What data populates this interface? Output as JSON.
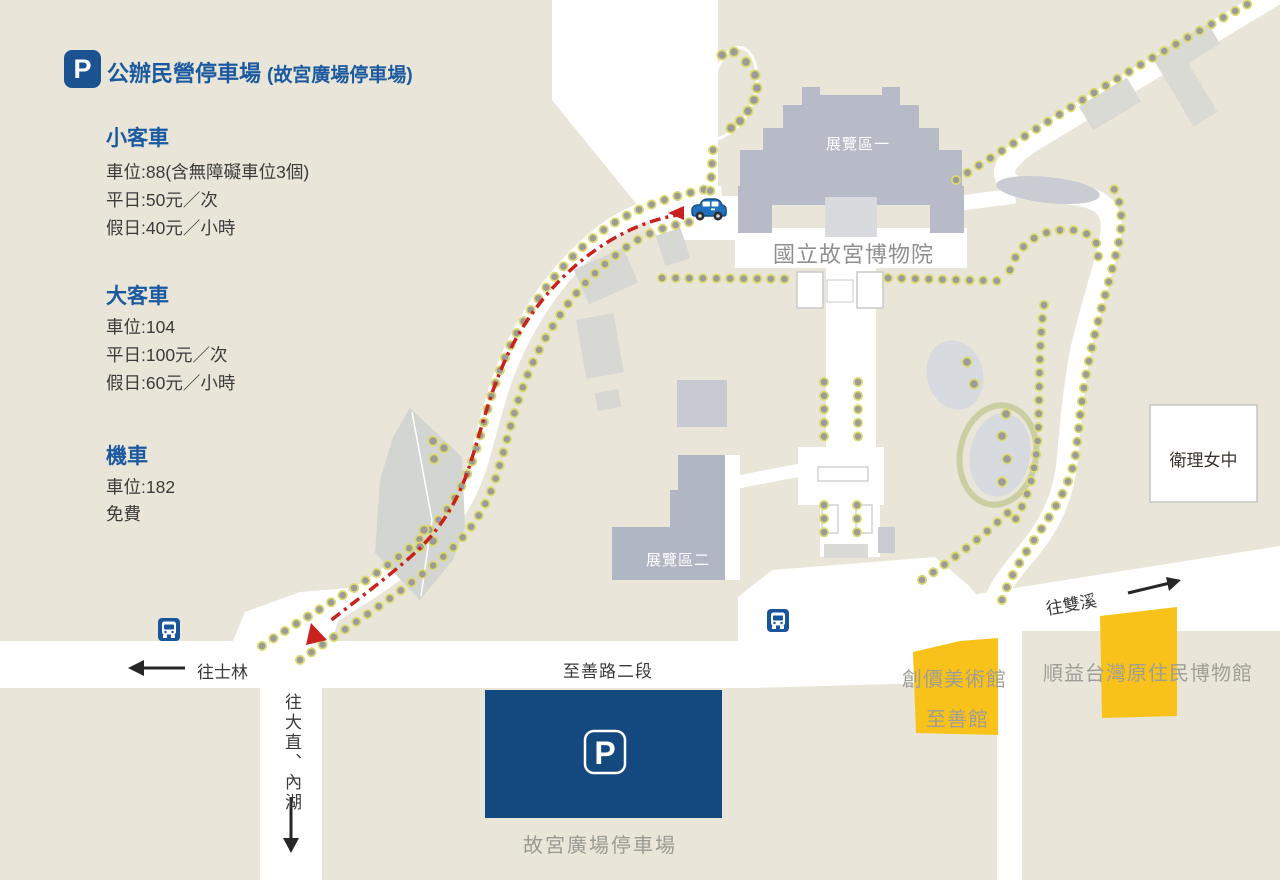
{
  "title": {
    "p": "P",
    "main": "公辦民營停車場",
    "sub": "(故宮廣場停車場)"
  },
  "info": {
    "sections": [
      {
        "heading": "小客車",
        "lines": [
          "車位:88(含無障礙車位3個)",
          "平日:50元／次",
          "假日:40元／小時"
        ]
      },
      {
        "heading": "大客車",
        "lines": [
          "車位:104",
          "平日:100元／次",
          "假日:60元／小時"
        ]
      },
      {
        "heading": "機車",
        "lines": [
          "車位:182",
          "免費"
        ]
      }
    ]
  },
  "map": {
    "labels": {
      "museum": "國立故宮博物院",
      "exhibition1": "展覽區一",
      "exhibition2": "展覽區二",
      "school": "衛理女中",
      "soka_art": "創價美術館",
      "zhishan_hall": "至善館",
      "shungye_museum": "順益台灣原住民博物館",
      "plaza_parking": "故宮廣場停車場",
      "road_zhishan": "至善路二段",
      "to_shilin": "往士林",
      "to_dazhi_neihu": "往大直、內湖",
      "to_shuangxi": "往雙溪",
      "parking_p": "P"
    }
  },
  "colors": {
    "background": "#e9e5d8",
    "road": "#ffffff",
    "building_gray": "#b6bbc7",
    "building_light": "#d7d7d4",
    "parking_navy": "#14497f",
    "title_blue": "#1b5aa0",
    "bus_blue": "#1a549b",
    "yellow_box": "#f8c21a",
    "route_red": "#c8211e",
    "tree_gray": "#9b9b99",
    "tree_yellow": "#dcda6f",
    "label_gray": "#9a9a94",
    "text_dark": "#3a3a3a"
  }
}
